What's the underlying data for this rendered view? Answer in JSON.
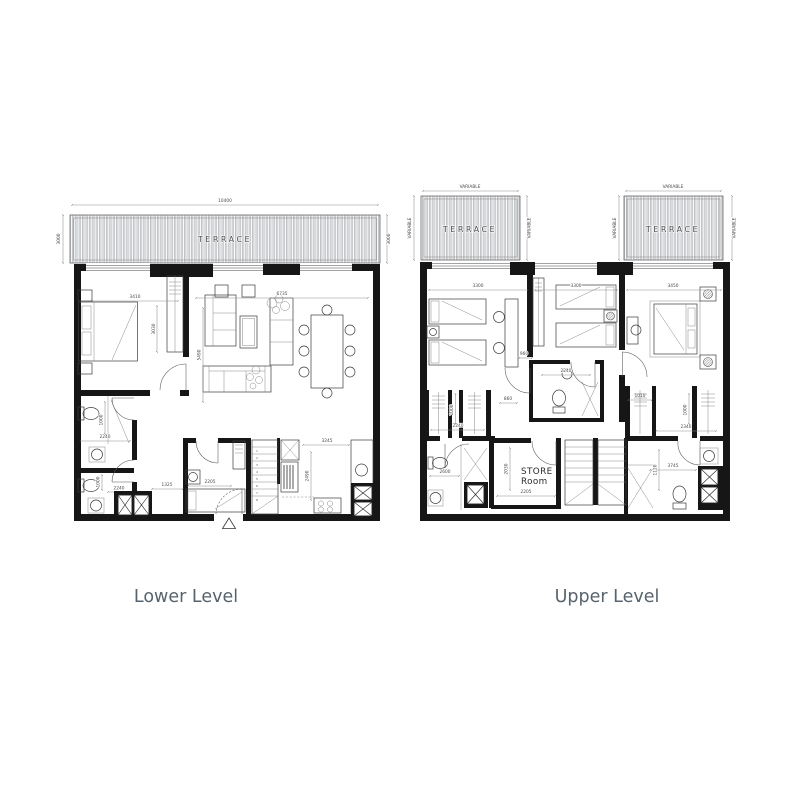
{
  "lower": {
    "title": "Lower Level",
    "terrace": {
      "label": "TERRACE",
      "width": "10400",
      "depth_left": "3000",
      "depth_right": "3000"
    },
    "dims": {
      "bedroom_width": "3410",
      "bedroom_depth": "3030",
      "living_width": "6735",
      "living_depth": "5490",
      "kitchen_width": "3245",
      "kitchen_depth": "2490",
      "bathroom1_width": "2240",
      "bathroom1_depth": "1000",
      "bathroom2_width": "2240",
      "bathroom2_depth": "1000",
      "entry_width": "1325",
      "maid_room_width": "2205"
    },
    "stair_steps": [
      "1",
      "2",
      "3",
      "4",
      "5",
      "6",
      "7",
      "8"
    ]
  },
  "upper": {
    "title": "Upper Level",
    "terrace_left": {
      "label": "TERRACE",
      "width": "VARIABLE",
      "depth_left": "VARIABLE",
      "depth_right": "VARIABLE"
    },
    "terrace_right": {
      "label": "TERRACE",
      "width": "VARIABLE",
      "depth_left": "VARIABLE",
      "depth_right": "VARIABLE"
    },
    "store_room": {
      "name_line1": "STORE",
      "name_line2": "Room",
      "width": "2205",
      "depth": "2030"
    },
    "dims": {
      "bedroom1_width": "3300",
      "bedroom2_width": "3300",
      "bedroom3_width": "3450",
      "bedroom2_recess": "960",
      "hall_width": "860",
      "bathroom_mid_width": "2240",
      "bedroom3_entry": "1010",
      "closets_left_width": "2240",
      "closet_left_depth": "1000",
      "bathroom_left_width": "2600",
      "closets_right_width": "2340",
      "closet_right_depth": "1000",
      "bathroom_right_width": "3745",
      "bathroom_right_depth": "1120"
    }
  }
}
